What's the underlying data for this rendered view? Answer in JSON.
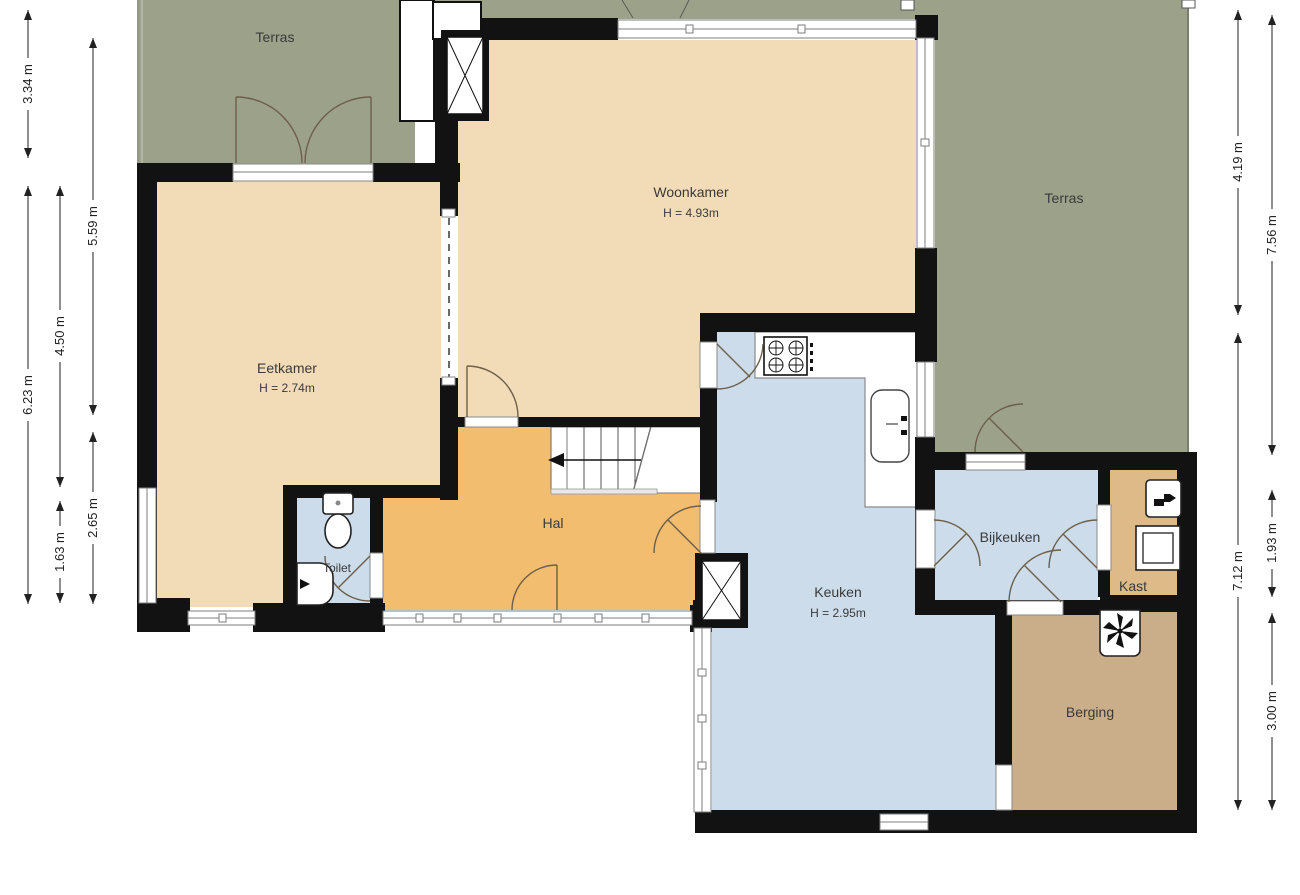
{
  "title": "Floor plan ground floor",
  "rooms": {
    "terras_left": {
      "label": "Terras"
    },
    "terras_right": {
      "label": "Terras"
    },
    "woonkamer": {
      "label": "Woonkamer",
      "height": "H = 4.93m"
    },
    "eetkamer": {
      "label": "Eetkamer",
      "height": "H = 2.74m"
    },
    "hal": {
      "label": "Hal"
    },
    "toilet": {
      "label": "Toilet"
    },
    "keuken": {
      "label": "Keuken",
      "height": "H = 2.95m"
    },
    "bijkeuken": {
      "label": "Bijkeuken"
    },
    "kast": {
      "label": "Kast"
    },
    "berging": {
      "label": "Berging"
    }
  },
  "dimensions": {
    "left": [
      {
        "label": "3.34 m"
      },
      {
        "label": "6.23 m"
      },
      {
        "label": "4.50 m"
      },
      {
        "label": "1.63 m"
      },
      {
        "label": "5.59 m"
      },
      {
        "label": "2.65 m"
      }
    ],
    "right": [
      {
        "label": "4.19 m"
      },
      {
        "label": "7.12 m"
      },
      {
        "label": "7.56 m"
      },
      {
        "label": "1.93 m"
      },
      {
        "label": "3.00 m"
      }
    ]
  },
  "icons": [
    "stairs-direction-arrow",
    "cooktop-icon",
    "kitchen-sink-icon",
    "toilet-icon",
    "hand-basin-icon",
    "washer-icon",
    "boiler-icon",
    "ventilation-fan-icon",
    "flue-x-icon"
  ],
  "colors": {
    "wall": "#121212",
    "living": "#f2dcb8",
    "hall": "#f3bd6f",
    "wet": "#ccdcea",
    "closet": "#ddba88",
    "storage": "#c9ae89",
    "terrace": "#9ca189"
  }
}
